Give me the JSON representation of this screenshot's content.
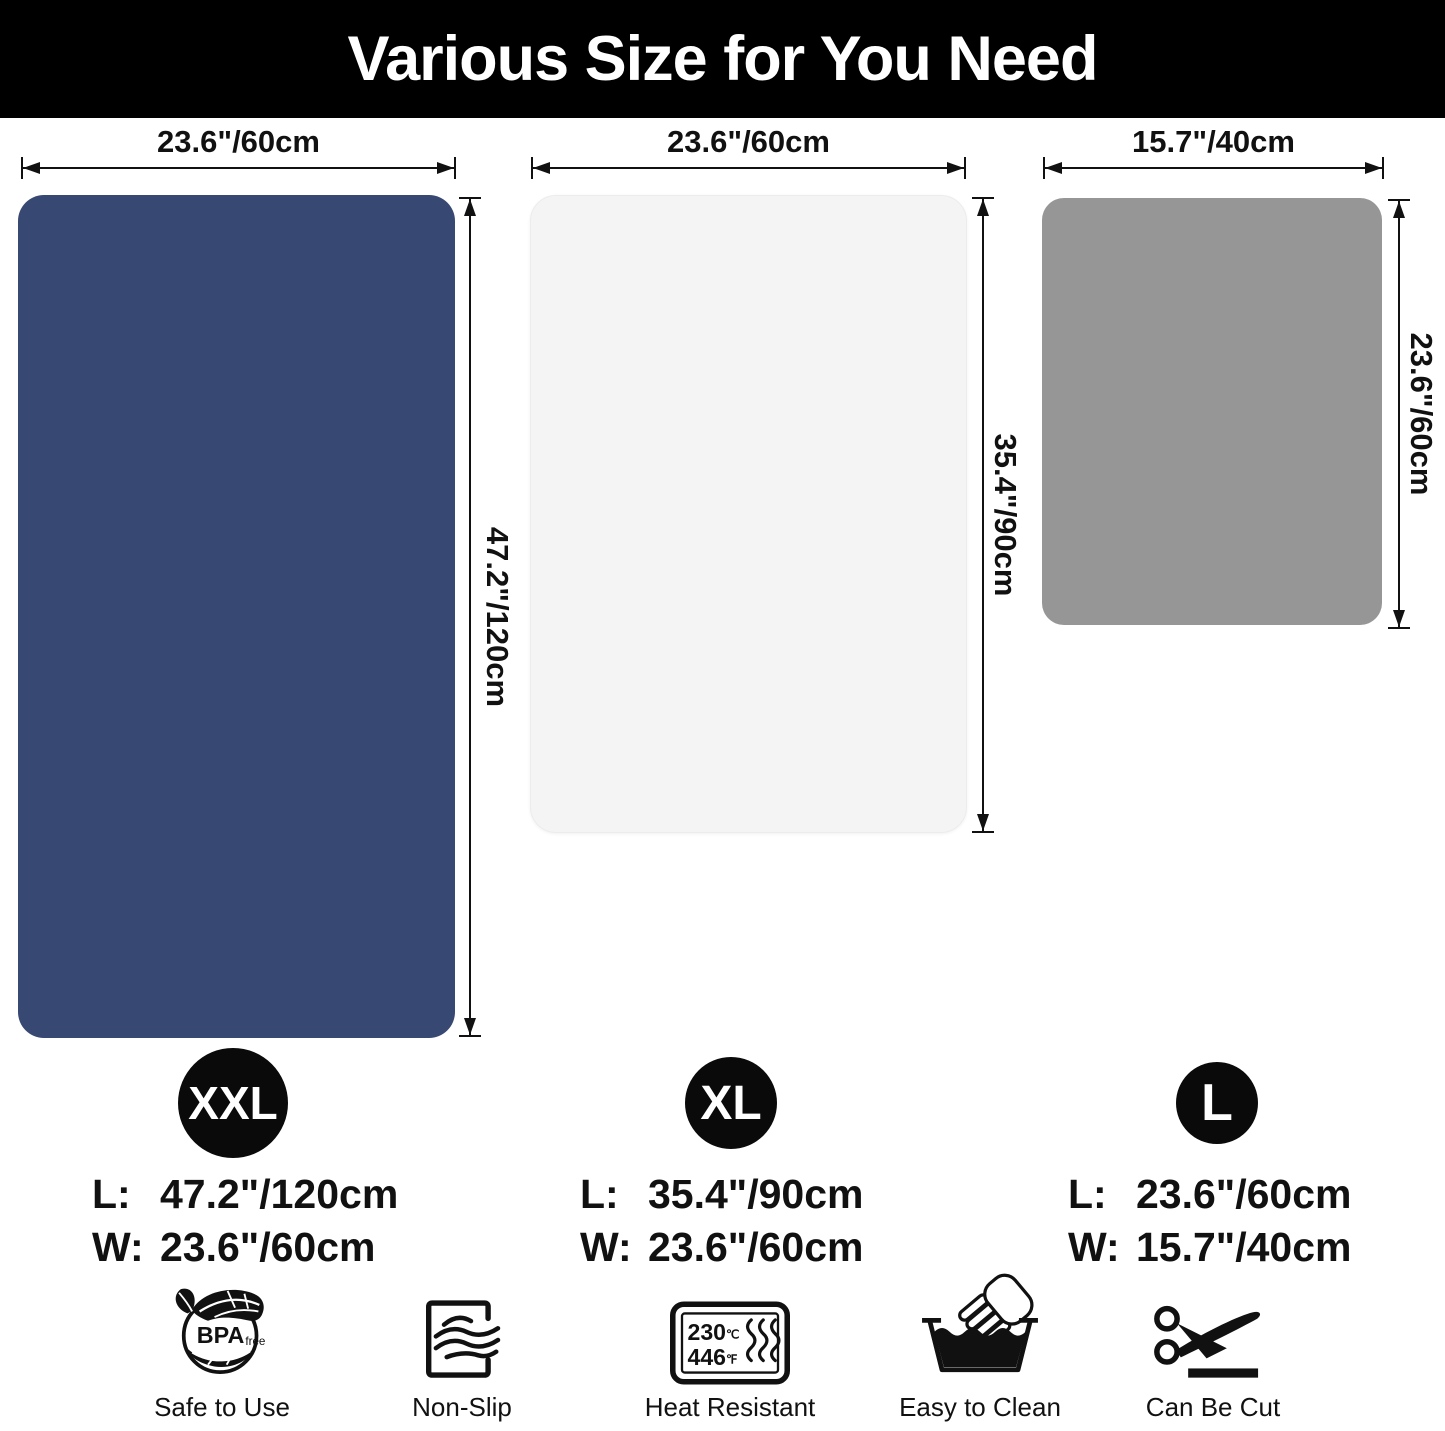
{
  "header": {
    "title": "Various Size for You Need"
  },
  "mats": [
    {
      "badge": "XXL",
      "color": "#374872",
      "top_dim": "23.6\"/60cm",
      "side_dim": "47.2\"/120cm",
      "size_rows": [
        {
          "label": "L:",
          "value": "47.2\"/120cm"
        },
        {
          "label": "W:",
          "value": "23.6\"/60cm"
        }
      ]
    },
    {
      "badge": "XL",
      "color": "#f4f4f4",
      "top_dim": "23.6\"/60cm",
      "side_dim": "35.4\"/90cm",
      "size_rows": [
        {
          "label": "L:",
          "value": "35.4\"/90cm"
        },
        {
          "label": "W:",
          "value": "23.6\"/60cm"
        }
      ]
    },
    {
      "badge": "L",
      "color": "#969696",
      "top_dim": "15.7\"/40cm",
      "side_dim": "23.6\"/60cm",
      "size_rows": [
        {
          "label": "L:",
          "value": "23.6\"/60cm"
        },
        {
          "label": "W:",
          "value": "15.7\"/40cm"
        }
      ]
    }
  ],
  "features": [
    {
      "label": "Safe to Use",
      "icon": "bpa-free-icon",
      "badge_text": "BPA",
      "badge_sub": "free"
    },
    {
      "label": "Non-Slip",
      "icon": "non-slip-icon"
    },
    {
      "label": "Heat Resistant",
      "icon": "heat-resistant-icon",
      "temp_c": "230",
      "temp_c_unit": "℃",
      "temp_f": "446",
      "temp_f_unit": "℉"
    },
    {
      "label": "Easy to Clean",
      "icon": "easy-to-clean-icon"
    },
    {
      "label": "Can Be Cut",
      "icon": "can-be-cut-icon"
    }
  ],
  "colors": {
    "header_bg": "#000000",
    "badge_bg": "#0a0a0a",
    "text": "#111111",
    "mat_xxl": "#374872",
    "mat_xl": "#f4f4f4",
    "mat_l": "#969696"
  }
}
